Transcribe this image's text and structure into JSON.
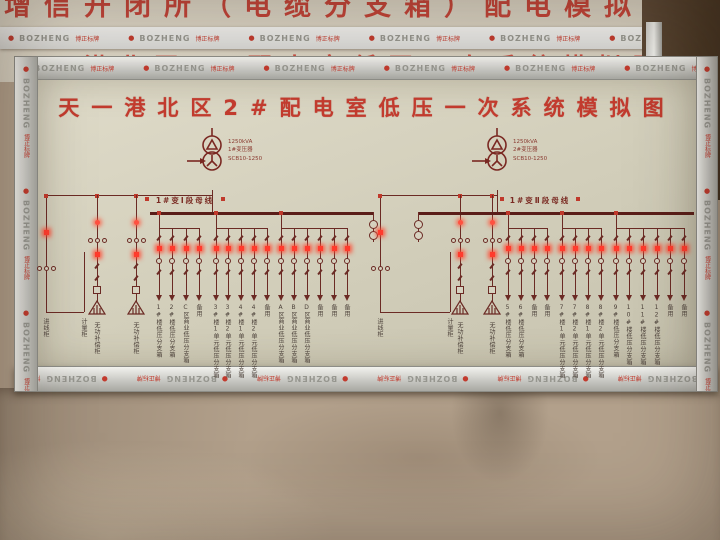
{
  "background": {
    "top_title": "增信开闭所（电缆分支箱）配电模拟图",
    "mid_title": "天一港北区1#配电室低压一次系统模拟图"
  },
  "frame": {
    "brand": "BOZHENG",
    "brand_cn": "博正标牌",
    "dot": "●"
  },
  "colors": {
    "diagram_line": "#6b2a24",
    "indicator_lit": "#ff3b2d",
    "title_red": "#c23b2e",
    "board_bg": "#d6d2c0"
  },
  "board": {
    "title": "天一港北区2#配电室低压一次系统模拟图",
    "sections": [
      {
        "transformer_label": [
          "1250kVA",
          "1#变压器",
          "SCB10-1250"
        ],
        "bus_label": "1#变Ⅰ段母线",
        "incoming_labels": [
          "进线柜",
          "计量柜"
        ],
        "capacitor_labels": [
          "无功补偿柜",
          "无功补偿柜"
        ],
        "feeders": [
          "1#楼低压分支箱",
          "2#楼低压分支箱",
          "C区商业低压分支箱",
          "备用",
          "3#楼1单元低压分支箱",
          "3#楼2单元低压分支箱",
          "4#楼1单元低压分支箱",
          "4#楼2单元低压分支箱",
          "备用",
          "A区商业低压分支箱",
          "B区商业低压分支箱",
          "D区商业低压分支箱",
          "备用",
          "备用",
          "备用"
        ]
      },
      {
        "transformer_label": [
          "1250kVA",
          "2#变压器",
          "SCB10-1250"
        ],
        "bus_label": "1#变Ⅱ段母线",
        "incoming_labels": [
          "进线柜",
          "计量柜"
        ],
        "capacitor_labels": [
          "无功补偿柜",
          "无功补偿柜"
        ],
        "feeders": [
          "5#楼低压分支箱",
          "6#楼低压分支箱",
          "备用",
          "备用",
          "7#楼1单元低压分支箱",
          "7#楼2单元低压分支箱",
          "8#楼1单元低压分支箱",
          "8#楼2单元低压分支箱",
          "9#楼低压分支箱",
          "10#楼低压分支箱",
          "11#楼低压分支箱",
          "12#楼低压分支箱",
          "备用",
          "备用"
        ]
      }
    ]
  }
}
